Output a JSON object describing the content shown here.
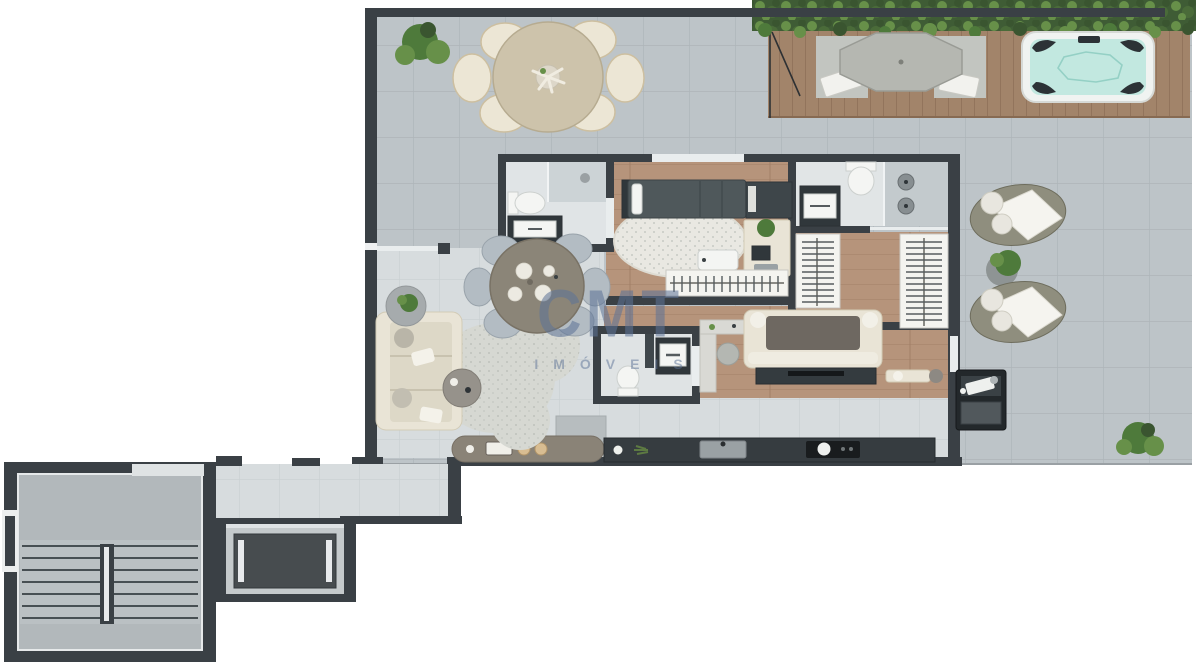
{
  "document": {
    "type": "apartment-floor-plan-render",
    "canvas": {
      "width": 1200,
      "height": 672
    }
  },
  "watermark": {
    "brand": "CMT",
    "subtitle": "IMÓVEIS"
  },
  "palette": {
    "white": "#ffffff",
    "wall": "#3a4045",
    "wallDeep": "#2b3034",
    "terrace": "#bdc4c8",
    "terraceLine": "#aeb5b9",
    "interior": "#d7dcde",
    "interiorLine": "#c9cfd2",
    "wood": "#b6947b",
    "woodLine": "#a27f67",
    "deck": "#a2846a",
    "deckLine": "#876a52",
    "hedge": "#3f5c35",
    "hedgeLight": "#567d3f",
    "plant": "#4e7a3b",
    "plantLight": "#679049",
    "water": "#c2e8e0",
    "waterLine": "#94d0c5",
    "tubShell": "#f0f3f1",
    "cream": "#e9e4d6",
    "creamLine": "#d2cbb6",
    "beigeTable": "#cdc3ab",
    "beigeLine": "#b6ab90",
    "darkFixture": "#30373b",
    "charcoal": "#363c40",
    "rug": "#e9e8e2",
    "rugDot": "#c7cac4",
    "blobRug": "#d6d8d2",
    "chairBlue": "#b3bcc3",
    "throwGray": "#6e6861",
    "watermark": "#5d7397",
    "corridor": "#d4d9db",
    "stairFloor": "#b2b8bb",
    "elevatorCar": "#474c4f",
    "glass": "#e9edee",
    "fixtureWhite": "#f4f5f3"
  },
  "plan": {
    "areas": [
      "terrace",
      "wood-deck",
      "bathroom-1",
      "bedroom",
      "bathroom-2",
      "walk-in-closet",
      "wc",
      "living-room",
      "kitchen",
      "lounge-dining",
      "right-terrace",
      "staircase",
      "corridor",
      "elevator"
    ],
    "objects": [
      "outdoor-dining-table",
      "outdoor-chairs",
      "patio-umbrella-table",
      "sun-loungers",
      "hot-tub",
      "hedge",
      "potted-plants",
      "toilet",
      "vanity",
      "shower",
      "double-shower",
      "bed",
      "round-rug",
      "clothes-rack",
      "closet-racks",
      "sofa-sectional",
      "tv-console",
      "desk",
      "indoor-dining-table",
      "area-rug",
      "kitchen-counter",
      "sink",
      "cooktop",
      "kitchen-island",
      "outdoor-grill",
      "stair-steps",
      "stair-handrail",
      "elevator-car"
    ]
  }
}
